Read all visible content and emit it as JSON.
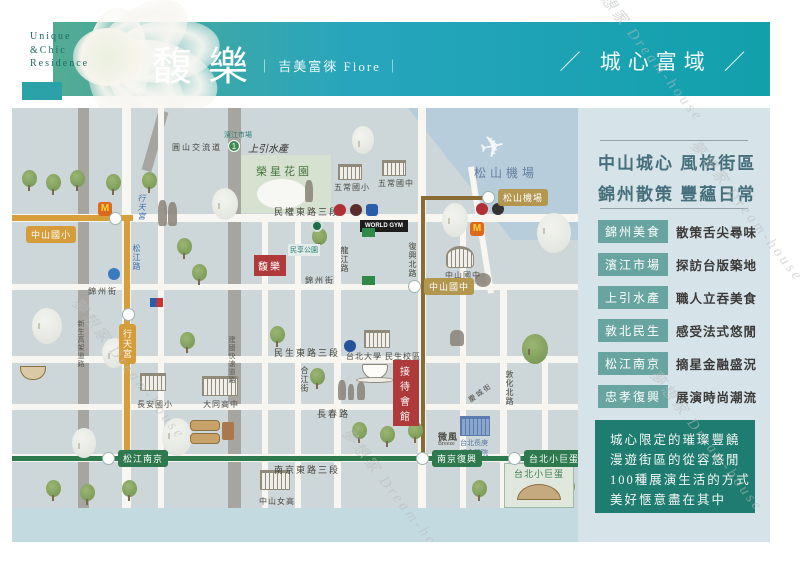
{
  "header": {
    "logo_line1": "Unique",
    "logo_line2": "&Chic",
    "logo_line3": "Residence",
    "title": "馥樂",
    "subtitle": "｜ 吉美富徠  Flore ｜",
    "tagline": "／ 城心富域 ／",
    "colors": {
      "band_left": "#53ab93",
      "band_mid": "#27a5bd",
      "band_right": "#12a0ab"
    }
  },
  "sidebar": {
    "heading_line1": "中山城心 風格街區",
    "heading_line2": "錦州散策 豐蘊日常",
    "items": [
      {
        "label": "錦州美食",
        "desc": "散策舌尖尋味"
      },
      {
        "label": "濱江市場",
        "desc": "探訪台版築地"
      },
      {
        "label": "上引水產",
        "desc": "職人立吞美食"
      },
      {
        "label": "敦北民生",
        "desc": "感受法式悠閒"
      },
      {
        "label": "松江南京",
        "desc": "摘星金融盛況"
      },
      {
        "label": "忠孝復興",
        "desc": "展演時尚潮流"
      }
    ],
    "footer_lines": [
      "城心限定的璀璨豐饒",
      "漫遊街區的從容悠閒",
      "100種展演生活的方式",
      "美好愜意盡在其中"
    ],
    "colors": {
      "pill": "#69a5a0",
      "box": "#1f7c71",
      "heading": "#45707b"
    }
  },
  "map": {
    "site_badge": "馥樂",
    "reception_line1": "接待",
    "reception_line2": "會館",
    "highway_no": "1",
    "roads": {
      "minquan": "民權東路三段",
      "minsheng": "民生東路三段",
      "changchun": "長春路",
      "nanjing": "南京東路三段",
      "jinzhou_w": "錦州街",
      "jinzhou_e": "錦州街",
      "songjiang": "松江路",
      "hejiang": "合江街",
      "longjiang": "龍江路",
      "fuxing": "復興北路",
      "dunhua": "敦化北路",
      "qingcheng": "慶城街",
      "xinsheng": "新生高架道路",
      "jianguo": "建國快速道路",
      "yuanshan": "圓山交流道"
    },
    "stations": {
      "zhongshan_elem": "中山國小",
      "xingtian_temple_st": "行天宮",
      "songshan_airport_st": "松山機場",
      "zhongshan_jhs_st": "中山國中",
      "songjiang_nanjing": "松江南京",
      "nanjing_fuxing": "南京復興",
      "taipei_arena_st": "台北小巨蛋"
    },
    "landmarks": {
      "rongxing_park": "榮星花園",
      "minxiang_park": "民享公園",
      "airport_area": "松山機場",
      "binjiang_market": "濱江市場",
      "shangyin_seafood": "上引水產",
      "xingtian_temple": "行天宮",
      "wuchang_elem": "五常國小",
      "wuchang_jhs": "五常國中",
      "zhongshan_jhs_school": "中山國中",
      "datong_hs": "大同高中",
      "changan_elem": "長安國小",
      "zhongshan_girls_hs": "中山女高",
      "ntpu_campus": "台北大學 民生校區",
      "breeze": "微風",
      "breeze_en": "Breeze",
      "chang_gung_hospital": "台北長庚紀念醫院",
      "taipei_arena": "台北小巨蛋",
      "world_gym": "WORLD GYM",
      "mcdonalds_m": "M"
    },
    "watermark": "夢想家 Dream-house",
    "colors": {
      "orange_line": "#d79f3c",
      "green_line": "#2e7a4e",
      "brown_line": "#8a6b34",
      "site_red": "#ae3a3b"
    }
  }
}
